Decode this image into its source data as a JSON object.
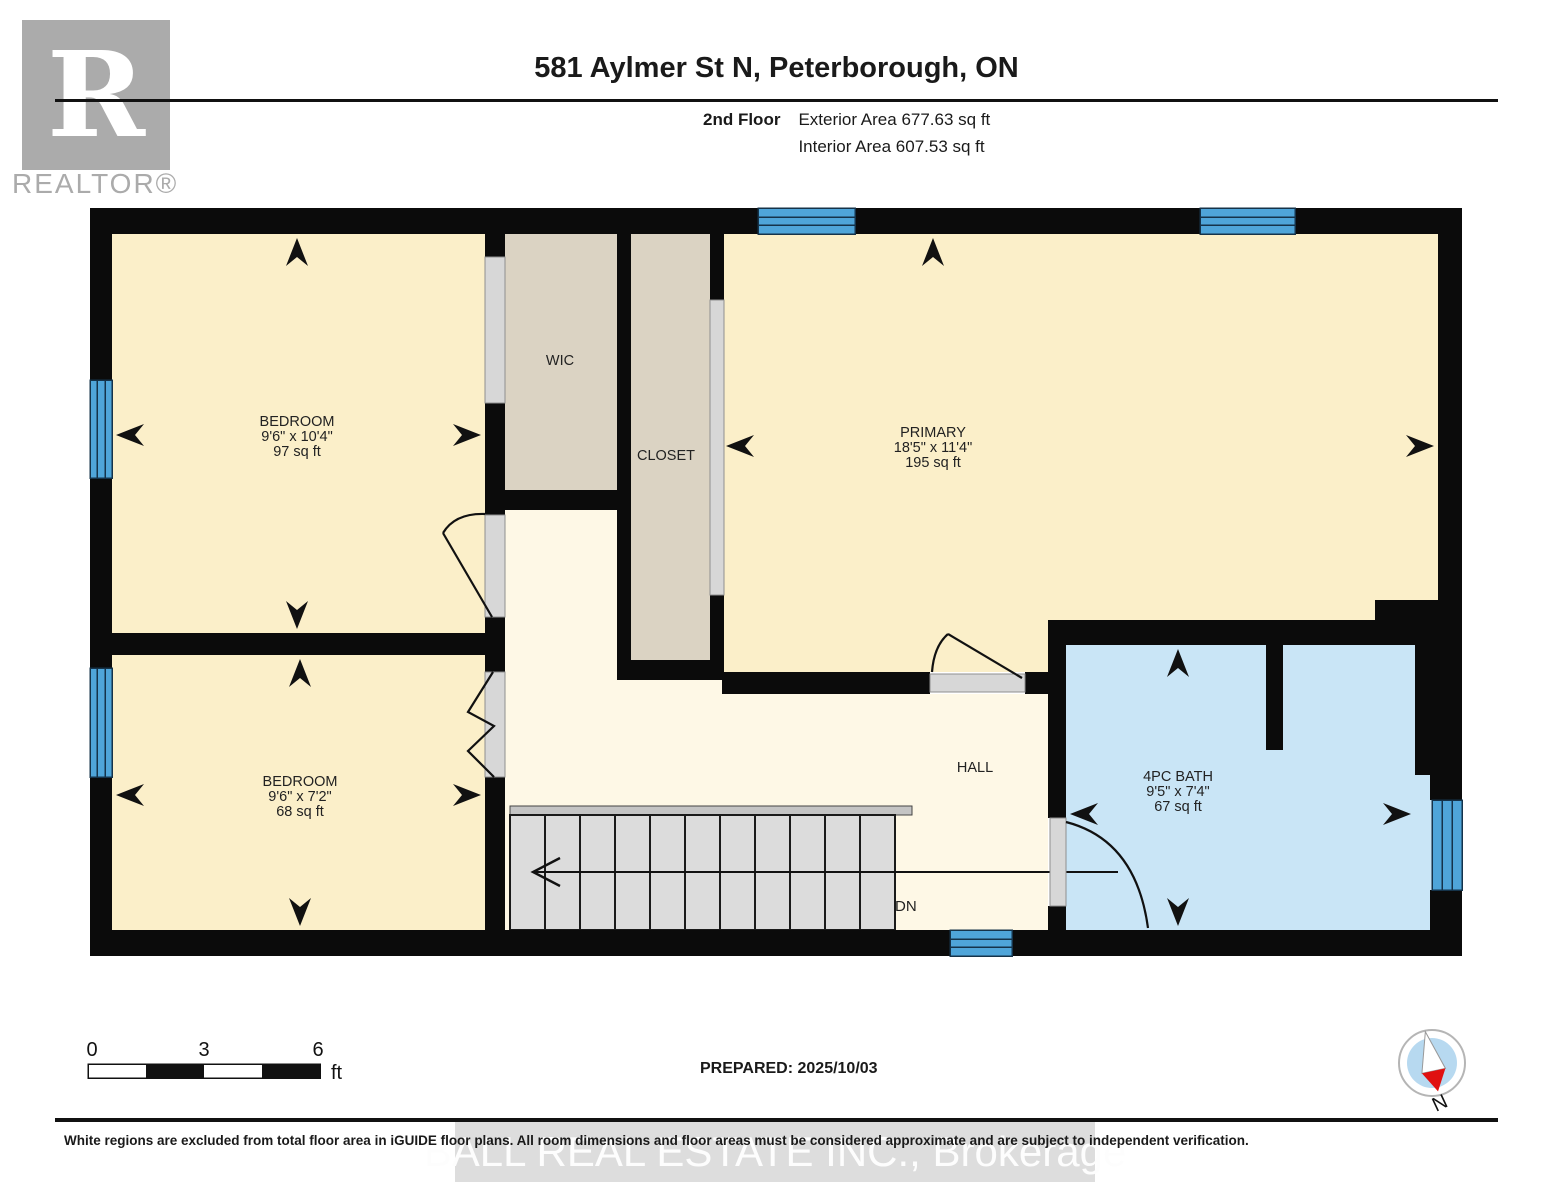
{
  "header": {
    "title": "581 Aylmer St N, Peterborough, ON",
    "floor_label": "2nd Floor",
    "exterior_area": "Exterior Area 677.63 sq ft",
    "interior_area": "Interior Area 607.53 sq ft",
    "logo_r": "R",
    "logo_text": "REALTOR®"
  },
  "rooms": {
    "bedroom1": {
      "name": "BEDROOM",
      "dims": "9'6\" x 10'4\"",
      "area": "97 sq ft"
    },
    "bedroom2": {
      "name": "BEDROOM",
      "dims": "9'6\" x 7'2\"",
      "area": "68 sq ft"
    },
    "primary": {
      "name": "PRIMARY",
      "dims": "18'5\" x 11'4\"",
      "area": "195 sq ft"
    },
    "bath": {
      "name": "4PC BATH",
      "dims": "9'5\" x 7'4\"",
      "area": "67 sq ft"
    },
    "wic": {
      "name": "WIC"
    },
    "closet": {
      "name": "CLOSET"
    },
    "hall": {
      "name": "HALL"
    }
  },
  "stairs": {
    "label": "DN"
  },
  "scale_bar": {
    "start": "0",
    "mid": "3",
    "end": "6",
    "unit": "ft"
  },
  "compass": {
    "label": "N"
  },
  "footer": {
    "prepared": "PREPARED: 2025/10/03",
    "disclaimer": "White regions are excluded from total floor area in iGUIDE floor plans. All room dimensions and floor areas must be considered approximate and are subject to independent verification.",
    "watermark": "BALL REAL ESTATE INC., Brokerage"
  },
  "colors": {
    "wall": "#0b0b0b",
    "room_cream": "#FBEFC9",
    "hall_ivory": "#FEF8E6",
    "closet_beige": "#DBD3C3",
    "bath_blue": "#C9E5F6",
    "window_blue": "#4FA5D9",
    "door_gray": "#D7D7D7",
    "stairs_gray": "#DCDCDC",
    "logo_gray": "#ABABAB",
    "compass_needle_red": "#E01010",
    "compass_disc_blue": "#B7D9F0"
  }
}
